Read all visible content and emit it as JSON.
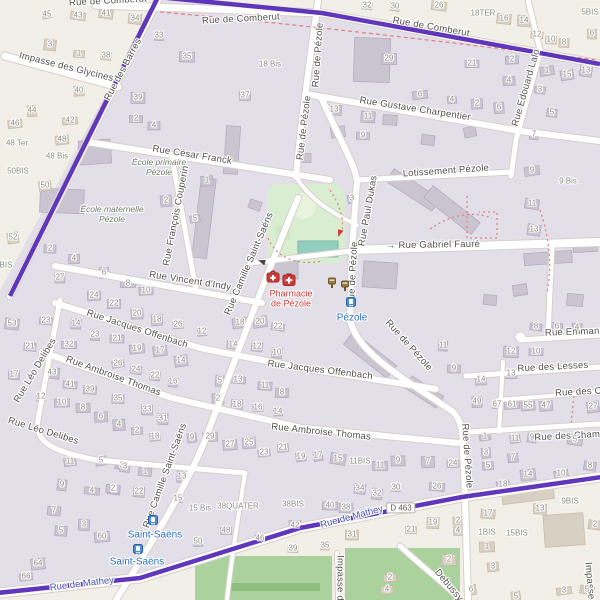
{
  "map": {
    "colors": {
      "outside_bg": "#f2efe8",
      "inside_residential": "#e2dfe9",
      "boundary_route": "#5326b5",
      "road_fill": "#ffffff",
      "road_casing": "#d6d0ca",
      "park": "#d9eed0",
      "pitch": "#93cfbf",
      "forest": "#abd29c",
      "building_inside": "#cbc4d1",
      "building_outside": "#d9d0c4",
      "footpath_red": "#e28585",
      "transit_blue": "#2a71c7",
      "pharmacy_red": "#ce3a35"
    },
    "street_labels": [
      {
        "t": "Rue de Comberut",
        "x": 108,
        "y": 2,
        "r": -3
      },
      {
        "t": "Impasse des Glycines",
        "x": 66,
        "y": 68,
        "r": 14
      },
      {
        "t": "Rue de Comberut",
        "x": 241,
        "y": 20,
        "r": -3
      },
      {
        "t": "Rue de Comberut",
        "x": 431,
        "y": 28,
        "r": 10
      },
      {
        "t": "Rue des Barres",
        "x": 124,
        "y": 70,
        "r": -62
      },
      {
        "t": "Rue Gustave Charpentier",
        "x": 415,
        "y": 110,
        "r": 9
      },
      {
        "t": "Rue de Pézole",
        "x": 319,
        "y": 55,
        "r": -86
      },
      {
        "t": "Rue de Pézole",
        "x": 305,
        "y": 128,
        "r": -83
      },
      {
        "t": "Rue Edouard Lalo",
        "x": 527,
        "y": 88,
        "r": -74
      },
      {
        "t": "Rue César Franck",
        "x": 192,
        "y": 156,
        "r": 9
      },
      {
        "t": "Rue François Couperin",
        "x": 177,
        "y": 216,
        "r": -79
      },
      {
        "t": "Lotissement Pézole",
        "x": 446,
        "y": 172,
        "r": -4
      },
      {
        "t": "→ Rue Gabriel Fauré",
        "x": 433,
        "y": 246,
        "r": -1
      },
      {
        "t": "Rue Paul Dukas",
        "x": 369,
        "y": 211,
        "r": -80
      },
      {
        "t": "Rue de Pézole",
        "x": 354,
        "y": 274,
        "r": -87
      },
      {
        "t": "Rue Camille Saint-Saëns",
        "x": 250,
        "y": 264,
        "r": -67
      },
      {
        "t": "Rue Vincent d'Indy",
        "x": 190,
        "y": 282,
        "r": 9
      },
      {
        "t": "Rue Jacques Offenbach",
        "x": 137,
        "y": 330,
        "r": 18
      },
      {
        "t": "Rue Ambroise Thomas",
        "x": 113,
        "y": 377,
        "r": 20
      },
      {
        "t": "Rue Jacques Offenbach",
        "x": 320,
        "y": 371,
        "r": 7
      },
      {
        "t": "Rue Ambroise Thomas",
        "x": 321,
        "y": 433,
        "r": 6
      },
      {
        "t": "Rue Léo Delibes",
        "x": 36,
        "y": 371,
        "r": -59
      },
      {
        "t": "Rue Léo Delibes",
        "x": 43,
        "y": 432,
        "r": 17
      },
      {
        "t": "Rue Camille Saint-Saëns",
        "x": 166,
        "y": 476,
        "r": -70
      },
      {
        "t": "Rue de Pézole",
        "x": 408,
        "y": 346,
        "r": 48
      },
      {
        "t": "Rue de Pézole",
        "x": 466,
        "y": 456,
        "r": 86
      },
      {
        "t": "Rue Emmanu",
        "x": 575,
        "y": 333,
        "r": -2
      },
      {
        "t": "Rue des Lesses",
        "x": 553,
        "y": 368,
        "r": -3
      },
      {
        "t": "Rue des Cit",
        "x": 581,
        "y": 393,
        "r": -3
      },
      {
        "t": "Rue des Champ",
        "x": 570,
        "y": 437,
        "r": -3
      },
      {
        "t": "Impasse d",
        "x": 339,
        "y": 578,
        "r": 90
      },
      {
        "t": "Impasse d",
        "x": 589,
        "y": 585,
        "r": 85
      },
      {
        "t": "Debussy",
        "x": 448,
        "y": 586,
        "r": 50
      }
    ],
    "area_labels": [
      {
        "t": "École primaire\nPézole",
        "x": 159,
        "y": 168
      },
      {
        "t": "École maternelle\nPézole",
        "x": 112,
        "y": 215
      }
    ],
    "poi_labels": [
      {
        "t": "Pharmacie\nde Pézole",
        "x": 291,
        "y": 299
      }
    ],
    "transit_labels": [
      {
        "t": "Pézole",
        "x": 352,
        "y": 318
      },
      {
        "t": "Saint-Saëns",
        "x": 155,
        "y": 535
      },
      {
        "t": "Saint-Saëns",
        "x": 137,
        "y": 562
      }
    ],
    "route_labels": [
      {
        "t": "Rue de Mathey",
        "x": 352,
        "y": 518,
        "r": -15
      },
      {
        "t": "Rue de Mathey",
        "x": 82,
        "y": 585,
        "r": -7
      }
    ],
    "badges": [
      {
        "t": "D 463",
        "x": 401,
        "y": 508
      }
    ],
    "misc_labels": [
      {
        "t": "18TER",
        "x": 483,
        "y": 13
      },
      {
        "t": "5BIS",
        "x": 590,
        "y": 12
      },
      {
        "t": "9 Bis",
        "x": 568,
        "y": 181
      },
      {
        "t": "18 Bis",
        "x": 270,
        "y": 64
      },
      {
        "t": "48 Ter",
        "x": 17,
        "y": 143
      },
      {
        "t": "48 Bis",
        "x": 57,
        "y": 156
      },
      {
        "t": "50BIS",
        "x": 18,
        "y": 171
      },
      {
        "t": "BIS",
        "x": 6,
        "y": 265
      },
      {
        "t": "11BIS",
        "x": 360,
        "y": 461
      },
      {
        "t": "9BIS",
        "x": 570,
        "y": 501
      },
      {
        "t": "1BIS",
        "x": 487,
        "y": 532
      },
      {
        "t": "15BIS",
        "x": 517,
        "y": 533
      },
      {
        "t": "38QUATER",
        "x": 238,
        "y": 506
      },
      {
        "t": "38BIS",
        "x": 293,
        "y": 504
      },
      {
        "t": "15 Bis",
        "x": 200,
        "y": 508
      }
    ],
    "house_numbers": [
      [
        47,
        14,
        "45"
      ],
      [
        78,
        15,
        "43"
      ],
      [
        106,
        13,
        "41"
      ],
      [
        135,
        18,
        "34"
      ],
      [
        50,
        44,
        "3"
      ],
      [
        79,
        53,
        "1"
      ],
      [
        106,
        55,
        "38"
      ],
      [
        159,
        35,
        "33"
      ],
      [
        187,
        56,
        "35"
      ],
      [
        138,
        97,
        "39"
      ],
      [
        136,
        118,
        "2"
      ],
      [
        154,
        125,
        "4"
      ],
      [
        245,
        95,
        "37"
      ],
      [
        79,
        90,
        "40"
      ],
      [
        32,
        110,
        "44"
      ],
      [
        70,
        120,
        "42"
      ],
      [
        15,
        123,
        "46"
      ],
      [
        62,
        139,
        "48"
      ],
      [
        45,
        185,
        "50"
      ],
      [
        13,
        237,
        "52"
      ],
      [
        367,
        5,
        "32"
      ],
      [
        395,
        6,
        "30"
      ],
      [
        439,
        5,
        "26"
      ],
      [
        504,
        18,
        "16"
      ],
      [
        524,
        20,
        "14"
      ],
      [
        537,
        34,
        "12"
      ],
      [
        551,
        39,
        "10"
      ],
      [
        564,
        42,
        "8"
      ],
      [
        592,
        33,
        "6"
      ],
      [
        389,
        58,
        "29"
      ],
      [
        472,
        63,
        "21"
      ],
      [
        512,
        59,
        "2"
      ],
      [
        509,
        80,
        "4"
      ],
      [
        477,
        103,
        "2"
      ],
      [
        499,
        107,
        "6"
      ],
      [
        452,
        99,
        "4"
      ],
      [
        420,
        94,
        "6"
      ],
      [
        547,
        70,
        "1"
      ],
      [
        567,
        74,
        "15"
      ],
      [
        586,
        70,
        "13"
      ],
      [
        540,
        89,
        "3"
      ],
      [
        552,
        112,
        "5"
      ],
      [
        534,
        134,
        "7"
      ],
      [
        334,
        109,
        "13"
      ],
      [
        368,
        116,
        "11"
      ],
      [
        363,
        135,
        "9"
      ],
      [
        50,
        248,
        "2"
      ],
      [
        74,
        258,
        "4"
      ],
      [
        60,
        277,
        "27"
      ],
      [
        104,
        272,
        "6"
      ],
      [
        128,
        283,
        "8"
      ],
      [
        146,
        290,
        "10"
      ],
      [
        94,
        295,
        "24"
      ],
      [
        207,
        180,
        "1"
      ],
      [
        166,
        200,
        "2"
      ],
      [
        195,
        218,
        "5"
      ],
      [
        352,
        198,
        "3"
      ],
      [
        532,
        170,
        "9"
      ],
      [
        532,
        203,
        "11"
      ],
      [
        534,
        229,
        "13"
      ],
      [
        536,
        326,
        "8"
      ],
      [
        557,
        326,
        "6"
      ],
      [
        577,
        327,
        "4"
      ],
      [
        443,
        345,
        "11"
      ],
      [
        511,
        351,
        "12"
      ],
      [
        536,
        351,
        "10"
      ],
      [
        454,
        368,
        "9"
      ],
      [
        511,
        373,
        "13"
      ],
      [
        481,
        379,
        "14"
      ],
      [
        477,
        401,
        "49"
      ],
      [
        497,
        404,
        "67"
      ],
      [
        512,
        404,
        "61"
      ],
      [
        528,
        405,
        "55"
      ],
      [
        546,
        405,
        "47"
      ],
      [
        593,
        406,
        "27"
      ],
      [
        485,
        436,
        "1"
      ],
      [
        515,
        438,
        "11"
      ],
      [
        532,
        437,
        "9"
      ],
      [
        575,
        439,
        "5"
      ],
      [
        12,
        323,
        "53"
      ],
      [
        46,
        320,
        "23"
      ],
      [
        30,
        346,
        "21"
      ],
      [
        14,
        374,
        "17"
      ],
      [
        76,
        323,
        "14"
      ],
      [
        95,
        334,
        "23"
      ],
      [
        69,
        344,
        "32"
      ],
      [
        117,
        338,
        "21"
      ],
      [
        114,
        303,
        "22"
      ],
      [
        137,
        313,
        "20"
      ],
      [
        157,
        319,
        "18"
      ],
      [
        178,
        324,
        "26"
      ],
      [
        202,
        331,
        "12"
      ],
      [
        137,
        348,
        "19"
      ],
      [
        160,
        350,
        "17"
      ],
      [
        181,
        360,
        "14"
      ],
      [
        118,
        363,
        "26"
      ],
      [
        136,
        369,
        "24"
      ],
      [
        155,
        375,
        "22"
      ],
      [
        173,
        381,
        "16"
      ],
      [
        52,
        372,
        "43"
      ],
      [
        70,
        384,
        "41"
      ],
      [
        90,
        389,
        "39"
      ],
      [
        118,
        398,
        "35"
      ],
      [
        147,
        409,
        "33"
      ],
      [
        163,
        418,
        "31"
      ],
      [
        41,
        396,
        "12"
      ],
      [
        62,
        402,
        "10"
      ],
      [
        83,
        407,
        "8"
      ],
      [
        101,
        416,
        "6"
      ],
      [
        119,
        424,
        "4"
      ],
      [
        137,
        430,
        "2"
      ],
      [
        155,
        436,
        "18"
      ],
      [
        192,
        437,
        "9"
      ],
      [
        240,
        322,
        "18"
      ],
      [
        260,
        321,
        "20"
      ],
      [
        278,
        326,
        "22"
      ],
      [
        233,
        344,
        "14"
      ],
      [
        257,
        346,
        "12"
      ],
      [
        277,
        352,
        "10"
      ],
      [
        220,
        380,
        "5"
      ],
      [
        238,
        379,
        "13"
      ],
      [
        265,
        385,
        "11"
      ],
      [
        282,
        392,
        "8"
      ],
      [
        218,
        398,
        "2"
      ],
      [
        237,
        404,
        "18"
      ],
      [
        258,
        407,
        "16"
      ],
      [
        278,
        411,
        "14"
      ],
      [
        210,
        436,
        "29"
      ],
      [
        230,
        444,
        "27"
      ],
      [
        249,
        442,
        "25"
      ],
      [
        264,
        452,
        "23"
      ],
      [
        283,
        447,
        "21"
      ],
      [
        301,
        456,
        "19"
      ],
      [
        318,
        455,
        "17"
      ],
      [
        338,
        458,
        "15"
      ],
      [
        122,
        465,
        "3"
      ],
      [
        145,
        471,
        "1"
      ],
      [
        114,
        489,
        "2"
      ],
      [
        139,
        491,
        "22"
      ],
      [
        182,
        476,
        "13"
      ],
      [
        178,
        498,
        "15"
      ],
      [
        330,
        505,
        "40"
      ],
      [
        346,
        507,
        "38"
      ],
      [
        352,
        534,
        "31"
      ],
      [
        295,
        525,
        "42"
      ],
      [
        226,
        530,
        "48"
      ],
      [
        260,
        538,
        "46"
      ],
      [
        198,
        541,
        "50"
      ],
      [
        102,
        536,
        "60"
      ],
      [
        38,
        563,
        "64"
      ],
      [
        26,
        576,
        "66"
      ],
      [
        70,
        461,
        "11"
      ],
      [
        101,
        460,
        "5"
      ],
      [
        125,
        466,
        "3"
      ],
      [
        62,
        484,
        "9"
      ],
      [
        92,
        490,
        "4"
      ],
      [
        113,
        488,
        "2"
      ],
      [
        54,
        510,
        "7"
      ],
      [
        61,
        530,
        "5"
      ],
      [
        84,
        524,
        "3"
      ],
      [
        293,
        548,
        "39"
      ],
      [
        325,
        545,
        "35"
      ],
      [
        380,
        465,
        "11"
      ],
      [
        398,
        460,
        "9"
      ],
      [
        428,
        461,
        "7"
      ],
      [
        453,
        463,
        "24"
      ],
      [
        488,
        465,
        "5"
      ],
      [
        513,
        457,
        "7"
      ],
      [
        486,
        452,
        "3"
      ],
      [
        528,
        474,
        "14"
      ],
      [
        561,
        473,
        "10"
      ],
      [
        503,
        484,
        "18"
      ],
      [
        590,
        465,
        "8"
      ],
      [
        360,
        488,
        "34"
      ],
      [
        377,
        493,
        "32"
      ],
      [
        396,
        487,
        "30"
      ],
      [
        437,
        486,
        "26"
      ],
      [
        488,
        513,
        "17"
      ],
      [
        540,
        508,
        "13"
      ],
      [
        433,
        522,
        "19"
      ],
      [
        411,
        529,
        "21"
      ],
      [
        458,
        520,
        "2"
      ],
      [
        458,
        530,
        "4"
      ],
      [
        487,
        546,
        "1"
      ],
      [
        449,
        559,
        "2"
      ],
      [
        390,
        577,
        "2"
      ],
      [
        387,
        589,
        "4"
      ],
      [
        493,
        566,
        "3"
      ],
      [
        471,
        589,
        "6"
      ],
      [
        516,
        596,
        "5"
      ],
      [
        564,
        590,
        "3"
      ],
      [
        587,
        589,
        "5"
      ],
      [
        595,
        524,
        "2"
      ]
    ],
    "icons": [
      {
        "k": "pharmacy-bag",
        "x": 273,
        "y": 279
      },
      {
        "k": "pharmacy-cross",
        "x": 289,
        "y": 282
      },
      {
        "k": "post-box",
        "x": 332,
        "y": 285
      },
      {
        "k": "post-box",
        "x": 345,
        "y": 288
      },
      {
        "k": "tram-stop",
        "x": 351,
        "y": 303
      },
      {
        "k": "tram-stop",
        "x": 153,
        "y": 521
      },
      {
        "k": "tram-stop",
        "x": 138,
        "y": 550
      },
      {
        "k": "arrow-red",
        "x": 339,
        "y": 233,
        "r": 115
      },
      {
        "k": "arrow-black",
        "x": 262,
        "y": 261,
        "r": 205
      }
    ]
  }
}
